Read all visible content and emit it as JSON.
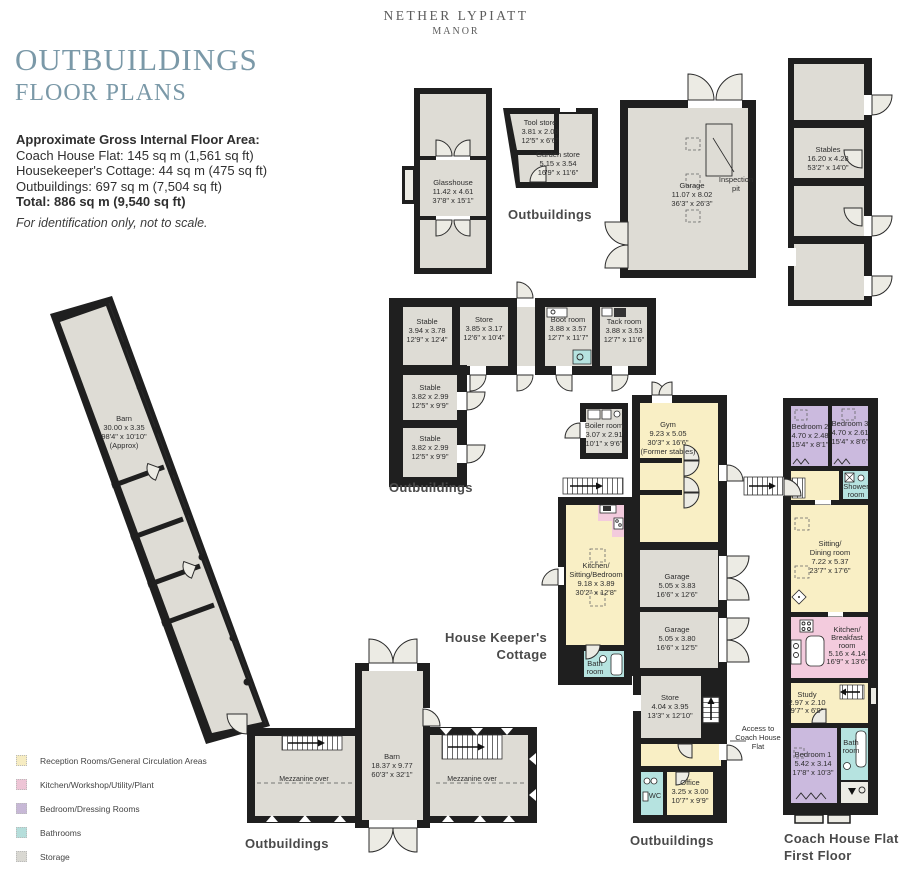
{
  "header": {
    "estate_line1": "NETHER LYPIATT",
    "estate_line2": "MANOR",
    "title": "OUTBUILDINGS",
    "subtitle": "FLOOR PLANS"
  },
  "area_summary": {
    "heading": "Approximate Gross Internal Floor Area:",
    "line1": "Coach House Flat: 145 sq m (1,561 sq ft)",
    "line2": "Housekeeper's Cottage: 44 sq m (475 sq ft)",
    "line3": "Outbuildings: 697 sq m (7,504 sq ft)",
    "total": "Total: 886 sq m (9,540 sq ft)",
    "disclaimer": "For identification only, not to scale."
  },
  "section_labels": {
    "outbuildings_stores": "Outbuildings",
    "outbuildings_stables": "Outbuildings",
    "outbuildings_barn": "Outbuildings",
    "outbuildings_office": "Outbuildings",
    "housekeepers_1": "House Keeper's",
    "housekeepers_2": "Cottage",
    "coach_house_1": "Coach House Flat",
    "coach_house_2": "First Floor"
  },
  "rooms": {
    "glasshouse": {
      "name": "Glasshouse",
      "dim_m": "11.42 x 4.61",
      "dim_ft": "37'8\" x 15'1\""
    },
    "tool_store": {
      "name": "Tool store",
      "dim_m": "3.81 x 2.00",
      "dim_ft": "12'5\" x 6'6\""
    },
    "garden_store": {
      "name": "Garden store",
      "dim_m": "5.15 x 3.54",
      "dim_ft": "16'9\" x 11'6\""
    },
    "garage_main": {
      "name": "Garage",
      "dim_m": "11.07 x 8.02",
      "dim_ft": "36'3\" x 26'3\""
    },
    "inspection_pit_1": "Inspection",
    "inspection_pit_2": "pit",
    "stables": {
      "name": "Stables",
      "dim_m": "16.20 x 4.28",
      "dim_ft": "53'2\" x 14'0\""
    },
    "stable_1": {
      "name": "Stable",
      "dim_m": "3.94 x 3.78",
      "dim_ft": "12'9\" x 12'4\""
    },
    "store_1": {
      "name": "Store",
      "dim_m": "3.85 x 3.17",
      "dim_ft": "12'6\" x 10'4\""
    },
    "boot_room": {
      "name": "Boot room",
      "dim_m": "3.88 x 3.57",
      "dim_ft": "12'7\" x 11'7\""
    },
    "tack_room": {
      "name": "Tack room",
      "dim_m": "3.88 x 3.53",
      "dim_ft": "12'7\" x 11'6\""
    },
    "stable_2": {
      "name": "Stable",
      "dim_m": "3.82 x 2.99",
      "dim_ft": "12'5\" x 9'9\""
    },
    "stable_3": {
      "name": "Stable",
      "dim_m": "3.82 x 2.99",
      "dim_ft": "12'5\" x 9'9\""
    },
    "barn_long": {
      "name": "Barn",
      "dim_m": "30.00 x 3.35",
      "dim_ft": "98'4\" x 10'10\"",
      "note": "(Approx)"
    },
    "boiler_room": {
      "name": "Boiler room",
      "dim_m": "3.07 x 2.91",
      "dim_ft": "10'1\" x 9'6\""
    },
    "gym": {
      "name": "Gym",
      "dim_m": "9.23 x 5.05",
      "dim_ft": "30'3\" x 16'6\"",
      "note": "(Former stables)"
    },
    "garage_1": {
      "name": "Garage",
      "dim_m": "5.05 x 3.83",
      "dim_ft": "16'6\" x 12'6\""
    },
    "garage_2": {
      "name": "Garage",
      "dim_m": "5.05 x 3.80",
      "dim_ft": "16'6\" x 12'5\""
    },
    "kitchen_sitting": {
      "name1": "Kitchen/",
      "name2": "Sitting/Bedroom",
      "dim_m": "9.18 x 3.89",
      "dim_ft": "30'2\" x 12'8\""
    },
    "bath_cottage": {
      "name1": "Bath",
      "name2": "room"
    },
    "store_2": {
      "name": "Store",
      "dim_m": "4.04 x 3.95",
      "dim_ft": "13'3\" x 12'10\""
    },
    "office": {
      "name": "Office",
      "dim_m": "3.25 x 3.00",
      "dim_ft": "10'7\" x 9'9\""
    },
    "wc": "WC",
    "access_1": "Access to",
    "access_2": "Coach House",
    "access_3": "Flat",
    "barn_big": {
      "name": "Barn",
      "dim_m": "18.37 x 9.77",
      "dim_ft": "60'3\" x 32'1\""
    },
    "mezzanine_left": "Mezzanine over",
    "mezzanine_right": "Mezzanine over",
    "bedroom_2": {
      "name": "Bedroom 2",
      "dim_m": "4.70 x 2.48",
      "dim_ft": "15'4\" x 8'1\""
    },
    "bedroom_3": {
      "name": "Bedroom 3",
      "dim_m": "4.70 x 2.61",
      "dim_ft": "15'4\" x 8'6\""
    },
    "shower_room": {
      "name1": "Shower",
      "name2": "room"
    },
    "sitting_dining": {
      "name1": "Sitting/",
      "name2": "Dining room",
      "dim_m": "7.22 x 5.37",
      "dim_ft": "23'7\" x 17'6\""
    },
    "kitchen_breakfast": {
      "name1": "Kitchen/",
      "name2": "Breakfast",
      "name3": "room",
      "dim_m": "5.16 x 4.14",
      "dim_ft": "16'9\" x 13'6\""
    },
    "study": {
      "name": "Study",
      "dim_m": "2.97 x 2.10",
      "dim_ft": "9'7\" x 6'9\""
    },
    "bedroom_1": {
      "name": "Bedroom 1",
      "dim_m": "5.42 x 3.14",
      "dim_ft": "17'8\" x 10'3\""
    },
    "bath_flat": {
      "name1": "Bath",
      "name2": "room"
    }
  },
  "legend": {
    "items": [
      {
        "label": "Reception Rooms/General Circulation Areas",
        "color": "#f6ecc2"
      },
      {
        "label": "Kitchen/Workshop/Utility/Plant",
        "color": "#eec5d6"
      },
      {
        "label": "Bedroom/Dressing Rooms",
        "color": "#c7b8d6"
      },
      {
        "label": "Bathrooms",
        "color": "#b5dedb"
      },
      {
        "label": "Storage",
        "color": "#d9d8d2"
      }
    ]
  },
  "colors": {
    "title_accent": "#7b99a8",
    "wall": "#1f1f1f",
    "reception": "#f9efc5",
    "kitchen": "#f3cbdd",
    "bedroom": "#cbbade",
    "bathroom": "#b6e3e0",
    "storage": "#dedcd5"
  }
}
